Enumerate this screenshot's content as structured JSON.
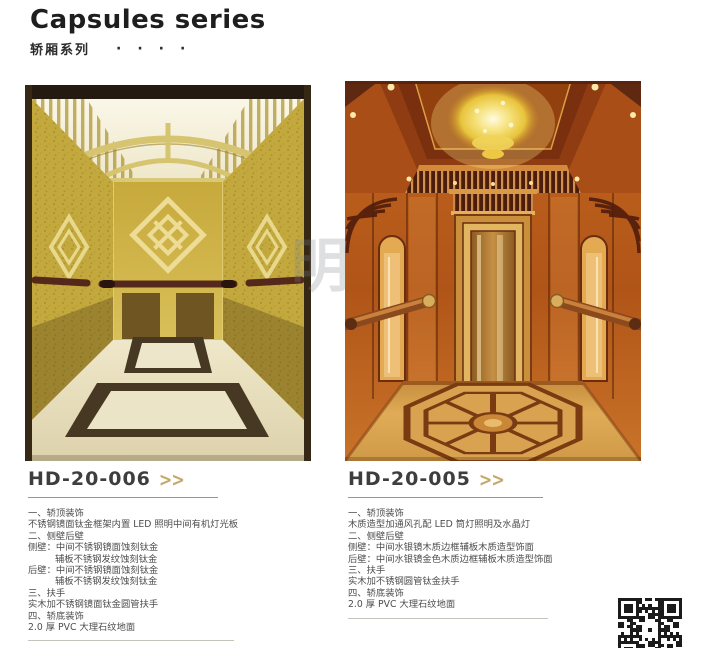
{
  "colors": {
    "accent_gold": "#c5a96b",
    "title_color": "#1e1e1e",
    "model_color": "#3e3e3e",
    "rule_color": "#97978c",
    "desc_color": "#4d4d4d",
    "cabin1_gold": "#c8ab3e",
    "cabin2_wood": "#b05518"
  },
  "header": {
    "title": "Capsules series",
    "subtitle": "轿厢系列",
    "dots": [
      "·",
      "·",
      "·",
      "·"
    ]
  },
  "watermark": "明",
  "products": [
    {
      "model": "HD-20-006",
      "chevron": ">>",
      "image_label": "titanium-gold etched mirror cabin",
      "desc": [
        {
          "t": "一、轿顶装饰"
        },
        {
          "t": "不锈钢镜面钛金框架内置 LED 照明中间有机灯光板"
        },
        {
          "t": "二、侧壁后壁"
        },
        {
          "t": "侧壁：中间不锈钢镜面蚀刻钛金"
        },
        {
          "t": "辅板不锈钢发纹蚀刻钛金",
          "indent": true
        },
        {
          "t": "后壁：中间不锈钢镜面蚀刻钛金"
        },
        {
          "t": "辅板不锈钢发纹蚀刻钛金",
          "indent": true
        },
        {
          "t": "三、扶手"
        },
        {
          "t": "实木加不锈钢镜面钛金圆管扶手"
        },
        {
          "t": "四、轿底装饰"
        },
        {
          "t": "2.0 厚 PVC 大理石纹地面"
        }
      ]
    },
    {
      "model": "HD-20-005",
      "chevron": ">>",
      "image_label": "wood panel cabin with crystal chandelier",
      "desc": [
        {
          "t": "一、轿顶装饰"
        },
        {
          "t": "木质造型加通风孔配 LED 筒灯照明及水晶灯"
        },
        {
          "t": "二、侧壁后壁"
        },
        {
          "t": "侧壁：中间水银镜木质边框辅板木质造型饰面"
        },
        {
          "t": "后壁：中间水银镜金色木质边框辅板木质造型饰面"
        },
        {
          "t": "三、扶手"
        },
        {
          "t": "实木加不锈钢圆管钛金扶手"
        },
        {
          "t": "四、轿底装饰"
        },
        {
          "t": "2.0 厚 PVC 大理石纹地面"
        }
      ]
    }
  ],
  "qr_icon": "qr-code"
}
